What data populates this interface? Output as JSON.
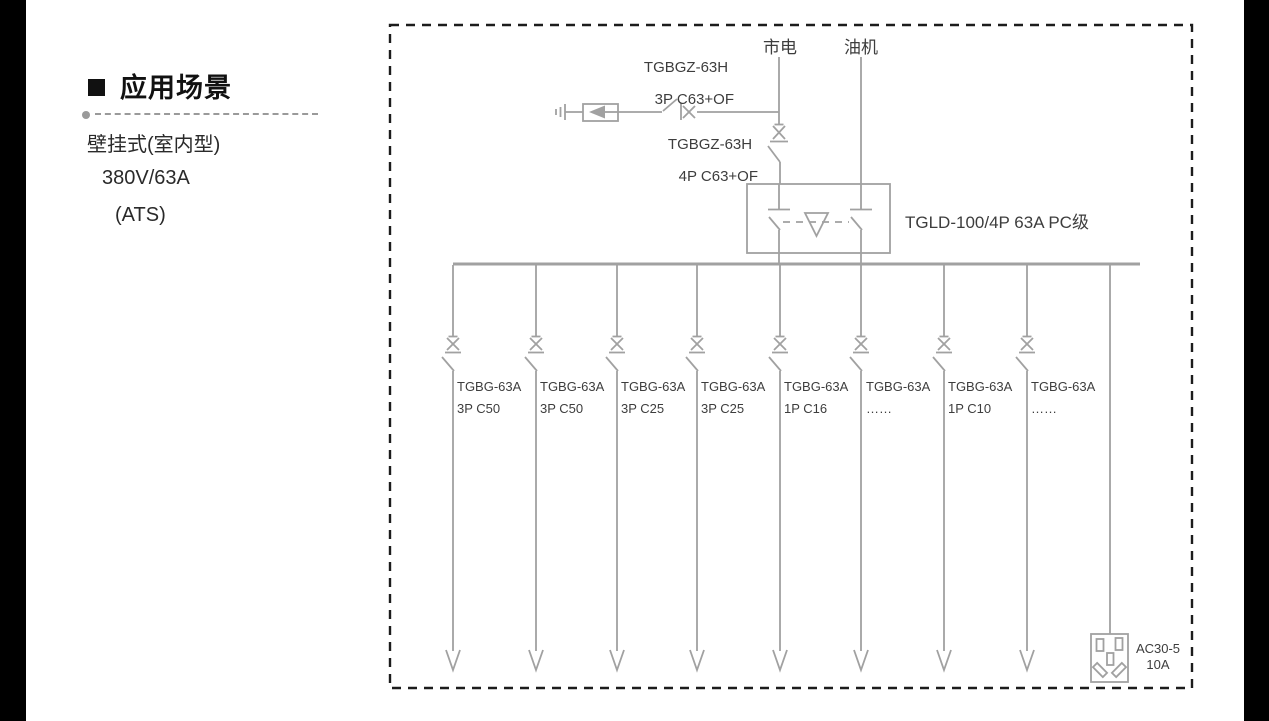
{
  "page": {
    "background": "#ffffff",
    "edge_bar_color": "#000000"
  },
  "left_panel": {
    "heading": "应用场景",
    "items": [
      "壁挂式(室内型)",
      "380V/63A",
      "(ATS)"
    ]
  },
  "diagram": {
    "colors": {
      "line": "#a1a1a1",
      "text": "#3d3d3d",
      "border": "#1c1c1c"
    },
    "sources": {
      "mains": "市电",
      "generator": "油机"
    },
    "spd_breaker": {
      "model": "TGBGZ-63H",
      "spec": "3P C63+OF"
    },
    "main_breaker": {
      "model": "TGBGZ-63H",
      "spec": "4P C63+OF"
    },
    "ats": {
      "label": "TGLD-100/4P 63A PC级"
    },
    "branches": [
      {
        "model": "TGBG-63A",
        "spec": "3P C50"
      },
      {
        "model": "TGBG-63A",
        "spec": "3P C50"
      },
      {
        "model": "TGBG-63A",
        "spec": "3P C25"
      },
      {
        "model": "TGBG-63A",
        "spec": "3P C25"
      },
      {
        "model": "TGBG-63A",
        "spec": "1P C16"
      },
      {
        "model": "TGBG-63A",
        "spec": "……"
      },
      {
        "model": "TGBG-63A",
        "spec": "1P C10"
      },
      {
        "model": "TGBG-63A",
        "spec": "……"
      }
    ],
    "socket": {
      "model": "AC30-5",
      "rating": "10A"
    }
  }
}
